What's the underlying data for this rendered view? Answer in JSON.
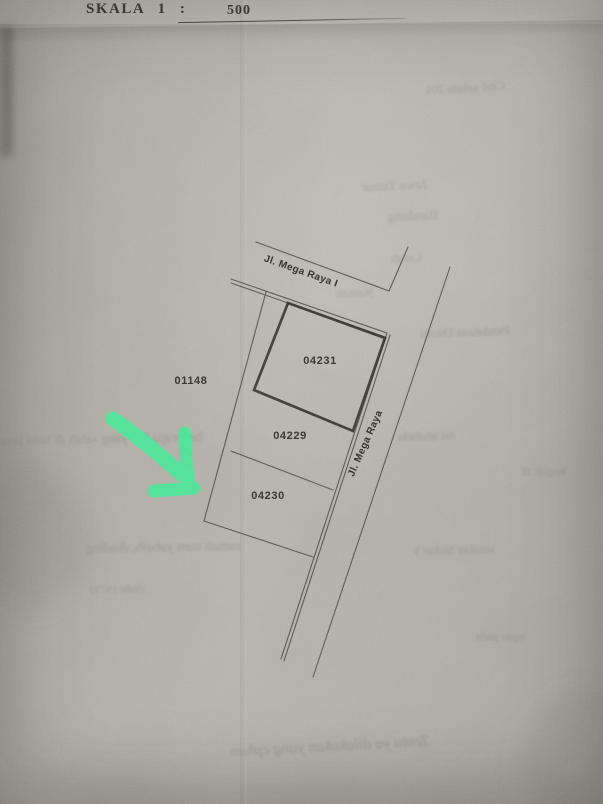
{
  "header": {
    "scale_label": "SKALA 1 :",
    "scale_value": "500"
  },
  "map": {
    "streets": [
      {
        "name": "Jl. Mega Raya I"
      },
      {
        "name": "Jl. Mega Raya"
      }
    ],
    "parcels": [
      {
        "id": "04231",
        "outline": "bold"
      },
      {
        "id": "04229",
        "outline": "thin"
      },
      {
        "id": "04230",
        "outline": "thin",
        "note": "indicated by green arrow"
      },
      {
        "id": "01148",
        "outline": "none"
      }
    ],
    "annotation": {
      "shape": "hand-drawn-arrow",
      "color": "#45EB97",
      "points_to_parcel": "04230"
    }
  },
  "bleed": [
    {
      "text": "Cttd xelam 201"
    },
    {
      "text": "Jawa Timur"
    },
    {
      "text": "Bandung"
    },
    {
      "text": "Lurah"
    },
    {
      "text": "Naman"
    },
    {
      "text": "Pendataan Dituju"
    },
    {
      "text": "beberapa hal yang salah di batu jaya"
    },
    {
      "text": "mi anabela"
    },
    {
      "text": "kegiat di"
    },
    {
      "text": "rumah num yabaib, dinding"
    },
    {
      "text": "amatan Sedan b"
    },
    {
      "text": "(lidn 1971)"
    },
    {
      "text": "ngan pada"
    },
    {
      "text": "Tentu ya dilakukan yang ephan"
    }
  ],
  "colors": {
    "paper": "#B2AFA7",
    "ink": "#2C2A25",
    "line": "#4E4B45",
    "accent_green": "#45EB97"
  }
}
